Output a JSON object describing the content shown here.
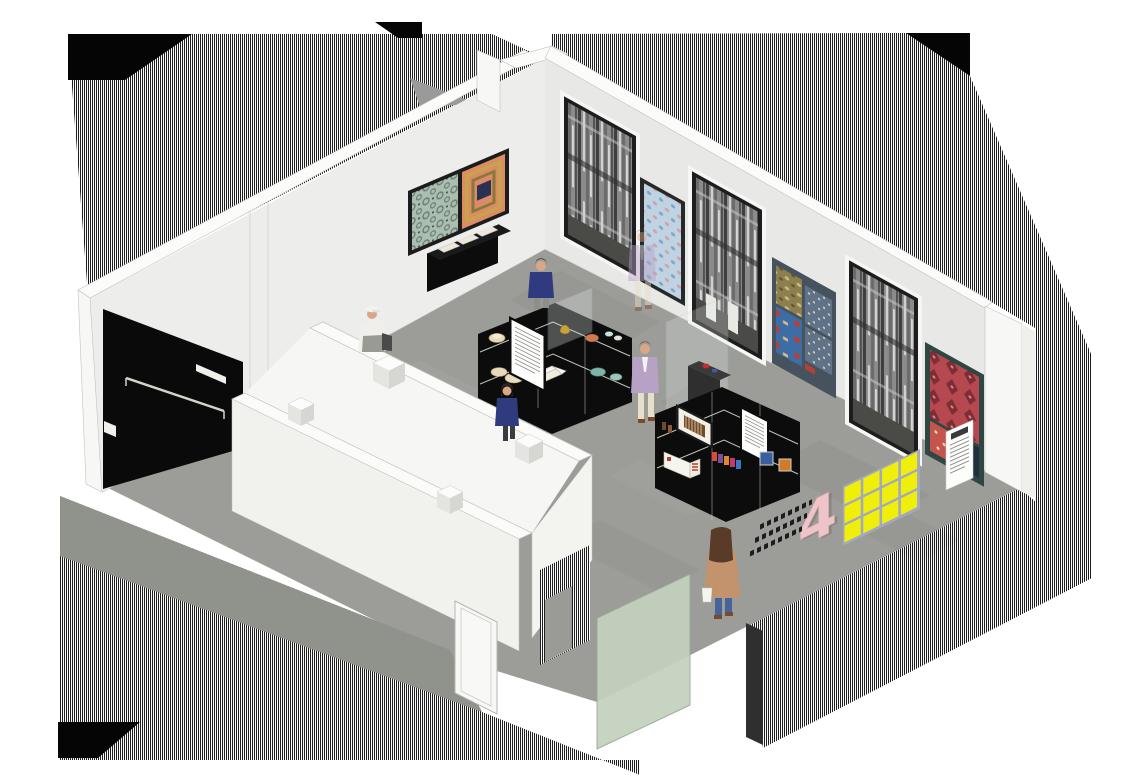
{
  "meta": {
    "title": "Axonometric cutaway illustration of a museum textile gallery with visitors",
    "style": "architectural isometric drawing with section-cut hatching",
    "legible_text": "none (all caption panels and floor graphics are illegible at this scale)"
  },
  "colors": {
    "bg": "#ffffff",
    "hatchDark": "#1f1f1f",
    "hatchLight": "#fbfbfb",
    "cutBlack": "#050505",
    "grayTri": "#9a9a9a",
    "wallBand": "#fbfbfa",
    "wallFaceLeft": "#ededeb",
    "wallFaceRight": "#e8e8e6",
    "wallShade": "#dededa",
    "endCap": "#f7f7f5",
    "edgeLine": "#c2c2be",
    "floor": "#9c9c98",
    "floorDark": "#8e8e8a",
    "floorStrip": "#90928c",
    "alcoveBlack": "#0a0a0a",
    "railGray": "#d3d3cc",
    "plaqueWhite": "#eef0ea",
    "caseBlack": "#0c0c0c",
    "caseTop": "#1a1a1a",
    "shelfLine": "#d8d8d0",
    "glassTint": "#e8efef",
    "glassEdge": "#b9c2c2",
    "greenGlass": "#c2d1bd",
    "greenGlassEdge": "#9aa896",
    "yellowTile": "#f0ef0a",
    "tileGap": "#a2a8bf",
    "pinkSign": "#efc4c8",
    "floorText": "#1c1c1c",
    "frameBlack": "#1c1c1c",
    "damaskBg": "#a9bfb0",
    "damaskFg": "#6f7a72",
    "salmonArt": "#dd8a66",
    "goldBand": "#c8a34e",
    "oliveBand": "#857a3a",
    "navyCenter": "#2a3152",
    "creamPanel": "#ece7d8",
    "photoBg": "#8b8b8b",
    "photoDark": "#3f3f3f",
    "photoMid": "#6a6a6a",
    "photoLight": "#d6d6d6",
    "nicheFloor": "#4a4a46",
    "blueArtBg": "#bfd3e2",
    "blueArtDotPink": "#d4a0aa",
    "blueArtDotBlue": "#86a4c4",
    "slateFrame": "#46525e",
    "oliveArt": "#8d7f4e",
    "oliveArtFg": "#cdbb7e",
    "blueRedBg": "#3e6da6",
    "blueRedFg": "#c23a30",
    "grayBlueArt": "#5f7287",
    "grayBlueFg": "#d6cfc0",
    "redArtBg": "#b5494f",
    "redArtFg": "#7e2d34",
    "redSample": "#c4554d",
    "tealFrame": "#2e4742",
    "paper": "#fdfdfc",
    "inkLine": "#8a8a8a",
    "plateCream": "#e8d9b8",
    "plateCoral": "#cf7a52",
    "plateTeal": "#7fb3a9",
    "bookWhite": "#f6f4ec",
    "modelRed": "#c03a2e",
    "kioskGray": "#2f2f2f",
    "skin": "#d9a788",
    "hairDark": "#2e2420",
    "hairBrown": "#6b4630",
    "hairCamel": "#5a3b28",
    "navySweater": "#303a7e",
    "grayPants": "#8f8f8a",
    "lavenderBlazer": "#b7a2c6",
    "creamPants": "#e6dfca",
    "camelCoat": "#c2936c",
    "jeansBlue": "#46639a",
    "bagWhite": "#f4f4f2",
    "capWhite": "#f2f2ef",
    "shirtWhite": "#f0efec",
    "shoeBrown": "#7a4a2e",
    "cubeTop": "#fcfcfc",
    "cubeLeft": "#e4e4e0",
    "cubeRight": "#d6d6d2"
  },
  "room": {
    "walls": "two white gallery walls meeting at a back corner, section-cut hatching outside",
    "alcove": "black recessed passage in left wall with handrail and small white plaque",
    "vestibule": "free-standing white open-top enclosure with door leaf and four small cubes on wall tops",
    "glass_screen": "pale green glass panel at entrance edge"
  },
  "artworks": {
    "left_wall": [
      {
        "id": "double-frame",
        "left_panel": "green-grey damask wallpaper",
        "right_panel": "salmon field with concentric gold/olive bands and navy centre"
      },
      {
        "id": "wall-display-case",
        "contents": "three cream document panels angled in a black wall case"
      }
    ],
    "back_wall": [
      {
        "id": "bw-niche-1",
        "type": "recessed black-and-white photographic textile panel"
      },
      {
        "id": "blue-dot-panel",
        "type": "pale blue textile with pink and blue motifs"
      },
      {
        "id": "bw-niche-2",
        "type": "recessed black-and-white photographic textile panel with white plinths"
      },
      {
        "id": "pattern-group-panel",
        "sub_panels": [
          "olive-gold pattern",
          "blue field with red motifs",
          "two grey-blue patterned sheets"
        ]
      },
      {
        "id": "bw-niche-3",
        "type": "recessed black-and-white photographic textile panel"
      },
      {
        "id": "red-damask-panel",
        "type": "red damask textile with small sample swatch and white caption sheet"
      }
    ]
  },
  "display_islands": [
    {
      "id": "island-1",
      "caption_panels": 1,
      "items": [
        "fluted cream dish",
        "gilt ornament",
        "coral plate",
        "pair of small plates",
        "two cream plates",
        "teal patterned plate",
        "open white book",
        "two teal plates",
        "glass vitrine"
      ]
    },
    {
      "id": "island-2",
      "caption_panels": 1,
      "items": [
        "framed striped print",
        "small brown bottles",
        "white and red model building",
        "row of printed packets",
        "blue framed tile",
        "orange framed tile"
      ]
    }
  ],
  "pedestal": {
    "items": [
      "red object",
      "blue object"
    ],
    "behind": "free-standing glass sheet"
  },
  "floor_graphics": {
    "yellow_board": {
      "rows": 3,
      "cols": 4
    },
    "pink_numeral": "4",
    "text_lines": 3
  },
  "people": [
    {
      "id": "attendant-cap",
      "desc": "attendant in white cap and shirt with dark bag, behind vestibule wall"
    },
    {
      "id": "visitor-navy-1",
      "desc": "visitor in navy sweater facing left wall case"
    },
    {
      "id": "visitor-navy-2",
      "desc": "visitor with dark bob in navy sweater at island 1"
    },
    {
      "id": "visitor-lavender",
      "desc": "man in lavender blazer and cream trousers walking (shown twice, once ghosted)"
    },
    {
      "id": "visitor-lavender-ghost",
      "desc": "ghosted duplicate of lavender man near blue panel"
    },
    {
      "id": "visitor-camel",
      "desc": "woman in camel coat and jeans with white bag, seen from behind"
    }
  ]
}
